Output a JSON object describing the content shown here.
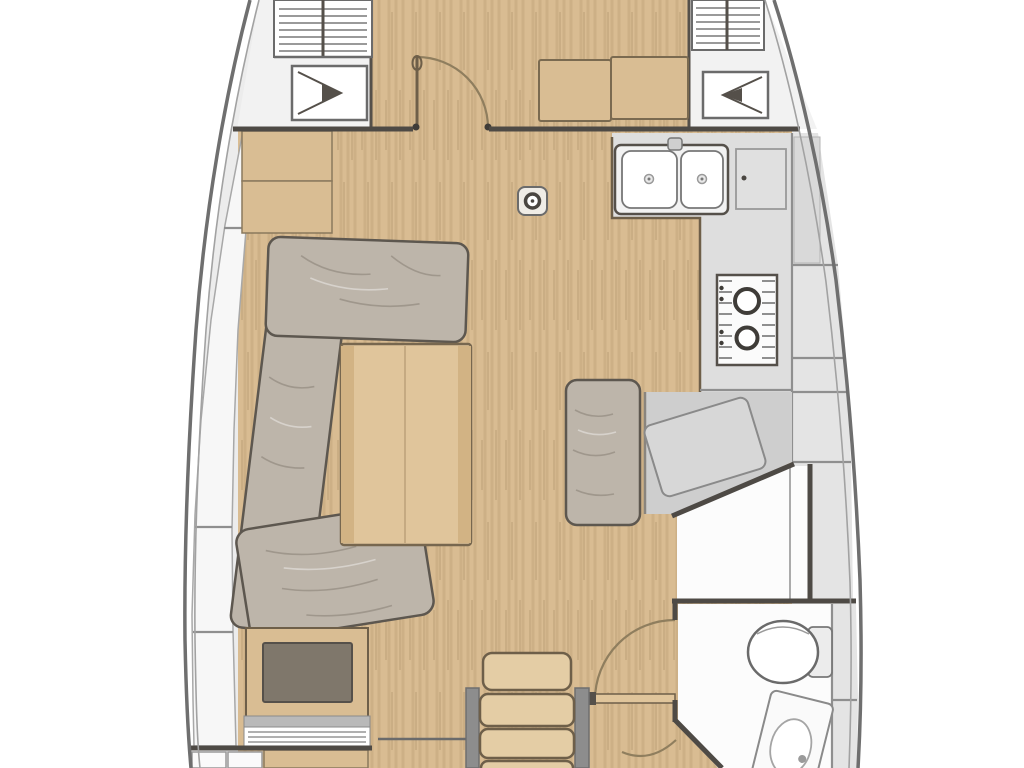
{
  "palette": {
    "white": "#ffffff",
    "deck": "#ececec",
    "zone_white": "#f2f2f2",
    "room_white": "#fcfcfc",
    "locker_white": "#f7f7f7",
    "wood_floor": "#d9bc92",
    "wood_furniture": "#d9bd93",
    "wood_table": "#e0c59b",
    "wood_steps": "#e4cda5",
    "cushion": "#bdb5aa",
    "counter": "#dedede",
    "platform": "#cecece",
    "side_cabinet": "#e4e4e4",
    "inset_dark": "#7f776b",
    "wall": "#4e4a45",
    "hull_line": "#6f6f6f",
    "hull_inner": "#a2a2a2",
    "edge_gray": "#8f8f8f",
    "furn_edge": "#6e5f49",
    "door_arc": "#8f7e5e",
    "fixture_line": "#6a6a6a"
  },
  "icons": {
    "deck_hatch_left": "triangle-right",
    "deck_hatch_right": "triangle-left",
    "ventilation_hatch": "horizontal-louvers",
    "mast_step": "ring-dot",
    "stove_burner": "double-ring",
    "sink_drain": "center-dot"
  }
}
